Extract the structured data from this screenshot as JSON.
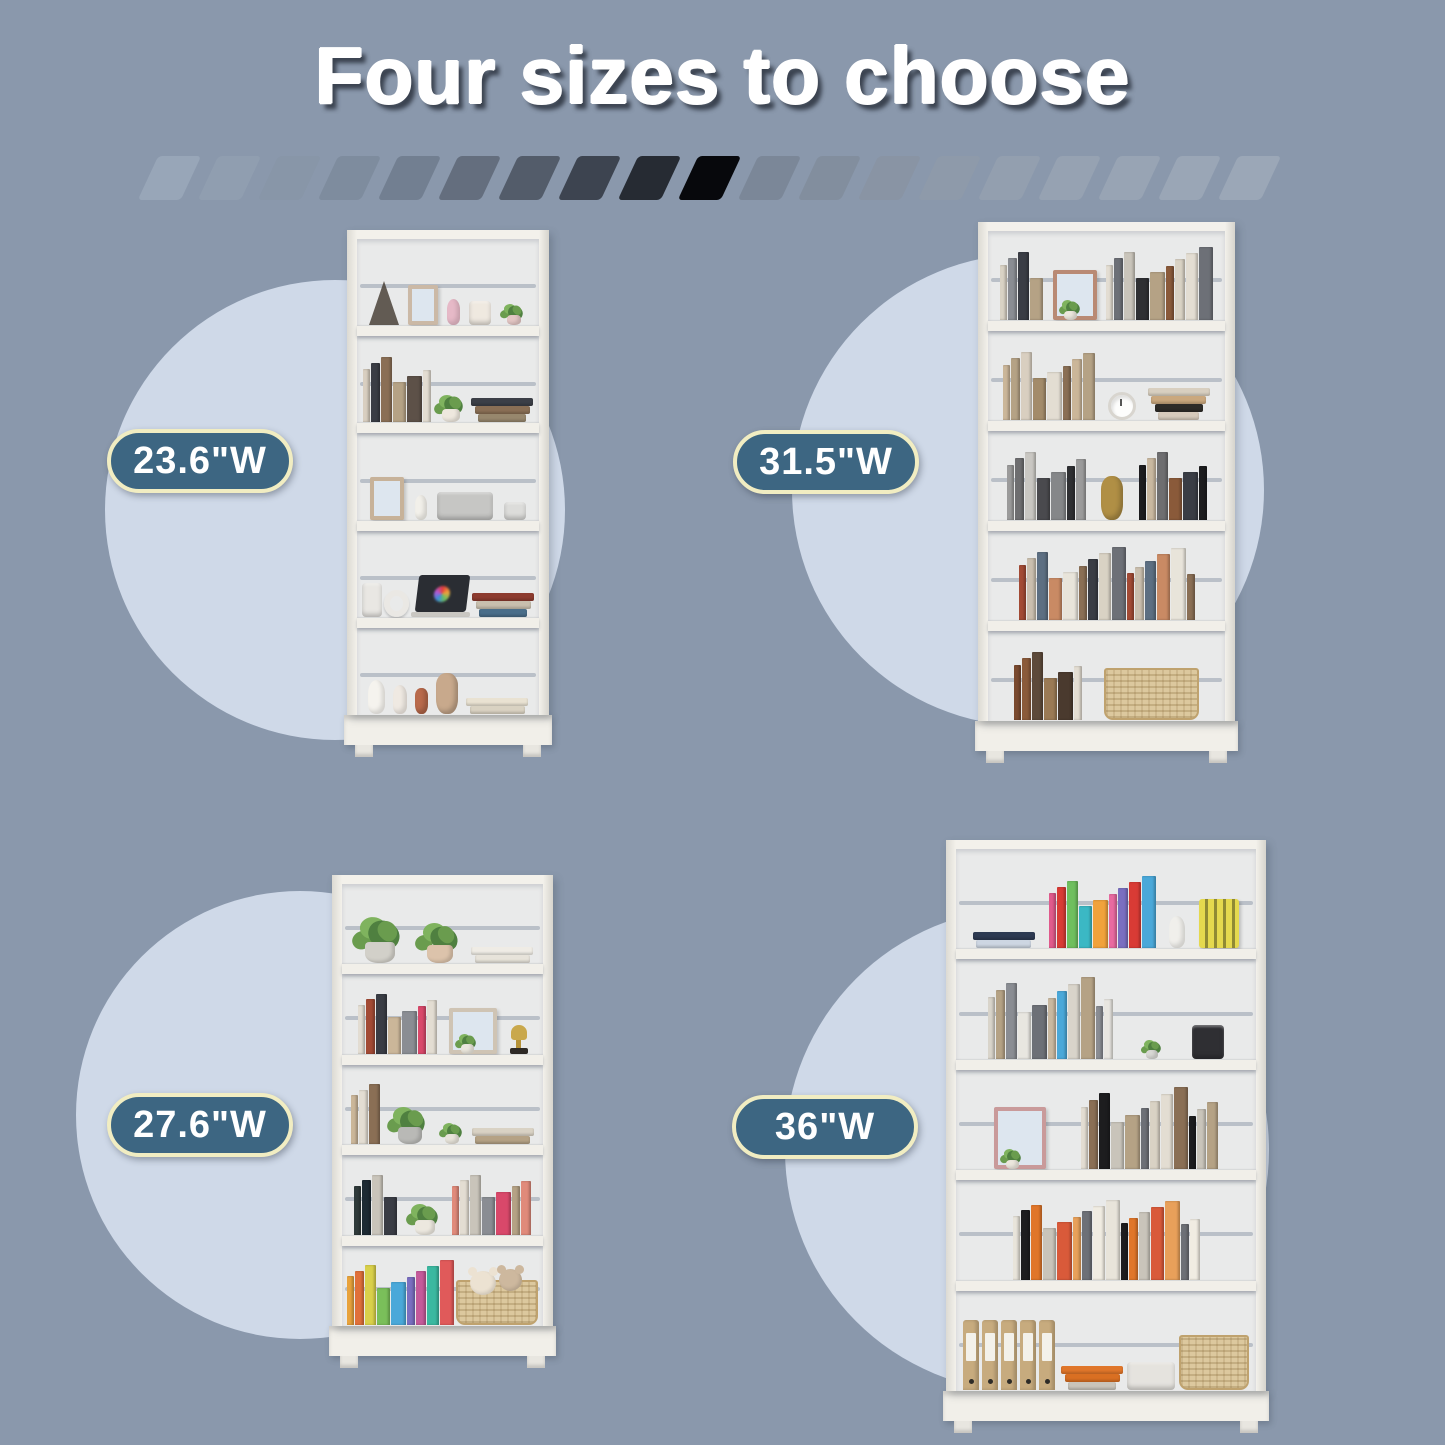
{
  "title": "Four sizes to choose",
  "colors": {
    "background": "#8a98ac",
    "circle": "#cfd9e8",
    "pill_fill": "#3d6682",
    "pill_border": "#f1edc2",
    "pill_text": "#ffffff",
    "title_text": "#ffffff",
    "title_shadow": "#3b4250",
    "case_white": "#f2f0ea"
  },
  "divider": {
    "slash_colors": [
      "#98a6b8",
      "#909eb0",
      "#8896a8",
      "#7e8c9e",
      "#727f91",
      "#646e7e",
      "#535c6a",
      "#3d4450",
      "#262b33",
      "#07080c",
      "#7b8798",
      "#828e9e",
      "#8994a4",
      "#8e9aaa",
      "#939faf",
      "#96a2b2",
      "#98a4b4",
      "#9aa6b6",
      "#9ba7b7"
    ]
  },
  "products": [
    {
      "id": "bookcase-23-6",
      "label": "23.6\"W",
      "layout": {
        "kase": {
          "x": 347,
          "y": 230,
          "w": 202,
          "h": 527
        },
        "circle": {
          "cx": 335,
          "cy": 510,
          "r": 230
        },
        "pill": {
          "cx": 200,
          "cy": 461
        }
      },
      "shelves": [
        [
          {
            "k": "tw"
          },
          {
            "k": "fr",
            "c": "#cbb9a6",
            "w": 30,
            "h": 0.5
          },
          {
            "k": "fg",
            "c": "#e6b9c7",
            "h": 0.32
          },
          {
            "k": "dv",
            "c": "#efe9e0",
            "w": 22,
            "h": 0.3
          },
          {
            "k": "pl",
            "pot": "#e3c6c4",
            "s": 14
          }
        ],
        [
          {
            "k": "bk",
            "n": 6,
            "c": [
              "#d9cfc0",
              "#3a3d45",
              "#8a6f55",
              "#b5a285",
              "#5d5148",
              "#e3ddd2"
            ]
          },
          {
            "k": "pl",
            "pot": "#eee8de",
            "s": 18
          },
          {
            "k": "fl",
            "c": [
              "#3c3f47",
              "#8a6f55",
              "#97876d"
            ]
          }
        ],
        [
          {
            "k": "fr",
            "c": "#c7b299",
            "w": 34,
            "h": 0.52
          },
          {
            "k": "fg",
            "c": "#f2f0ea",
            "h": 0.3
          },
          {
            "k": "dv",
            "c": "#c6c6c4",
            "w": 56,
            "h": 0.34
          },
          {
            "k": "dv",
            "c": "#dcdcda",
            "w": 22,
            "h": 0.22
          }
        ],
        [
          {
            "k": "dv",
            "c": "#e9e7e3",
            "w": 22,
            "h": 0.42
          },
          {
            "k": "hp"
          },
          {
            "k": "lp"
          },
          {
            "k": "fl",
            "c": [
              "#8c3b2f",
              "#c8bfae",
              "#4a6e8a"
            ]
          }
        ],
        [
          {
            "k": "fg",
            "c": "#f5f3ee",
            "h": 0.42
          },
          {
            "k": "fg",
            "c": "#efe9e2",
            "h": 0.36
          },
          {
            "k": "vs",
            "c": "#b96a4b",
            "w": 13,
            "h": 0.32
          },
          {
            "k": "vs",
            "c": "#c8a98c",
            "w": 22,
            "h": 0.5
          },
          {
            "k": "fl",
            "c": [
              "#e9e2d2",
              "#d9d2c2"
            ]
          }
        ]
      ]
    },
    {
      "id": "bookcase-31-5",
      "label": "31.5\"W",
      "layout": {
        "kase": {
          "x": 978,
          "y": 222,
          "w": 257,
          "h": 541
        },
        "circle": {
          "cx": 1028,
          "cy": 490,
          "r": 236
        },
        "pill": {
          "cx": 826,
          "cy": 462
        }
      },
      "shelves": [
        [
          {
            "k": "bk",
            "n": 4,
            "c": [
              "#d9d2c4",
              "#8a8d93",
              "#3a3d45",
              "#b5a285"
            ]
          },
          {
            "k": "fp",
            "c": "#b98a74",
            "w": 44,
            "h": 0.6
          },
          {
            "k": "bk",
            "n": 9,
            "c": [
              "#e3ddd2",
              "#6d7077",
              "#c9c4ba",
              "#2f3033",
              "#b5a285",
              "#8a5a3a",
              "#d9d2c4"
            ]
          }
        ],
        [
          {
            "k": "bk",
            "n": 8,
            "c": [
              "#cbb699",
              "#b5a285",
              "#d9cfc0",
              "#a38b6a",
              "#e3ddd2",
              "#8a6f55"
            ]
          },
          {
            "k": "ck"
          },
          {
            "k": "fl",
            "c": [
              "#d8cfc0",
              "#caa87e",
              "#2e2c28",
              "#d6cabb"
            ]
          }
        ],
        [
          {
            "k": "bk",
            "n": 7,
            "c": [
              "#9b9b9b",
              "#6e6e70",
              "#c9c7c2",
              "#4a4a4e",
              "#858789",
              "#2f3033"
            ]
          },
          {
            "k": "vs",
            "c": "#b08f45",
            "w": 22,
            "h": 0.52
          },
          {
            "k": "bk",
            "n": 6,
            "c": [
              "#1d1d1f",
              "#c9b8a0",
              "#6e6e70",
              "#8a5a3a",
              "#3a3d45"
            ]
          }
        ],
        [
          {
            "k": "bk",
            "n": 15,
            "c": [
              "#a34b35",
              "#cabfae",
              "#5d6f82",
              "#c98a64",
              "#e8e4da",
              "#8a6f55",
              "#3a3d45",
              "#d9d2c4",
              "#6d7077"
            ]
          }
        ],
        [
          {
            "k": "bk",
            "n": 6,
            "c": [
              "#7a4a2f",
              "#8a5a3a",
              "#5d4a3a",
              "#9a7a55",
              "#4a3a2e",
              "#e3ddd2"
            ]
          },
          {
            "k": "bs",
            "w": 95,
            "h": 0.62
          }
        ]
      ]
    },
    {
      "id": "bookcase-27-6",
      "label": "27.6\"W",
      "layout": {
        "kase": {
          "x": 332,
          "y": 875,
          "w": 221,
          "h": 493
        },
        "circle": {
          "cx": 300,
          "cy": 1115,
          "r": 224
        },
        "pill": {
          "cx": 200,
          "cy": 1125
        }
      },
      "shelves": [
        [
          {
            "k": "pl",
            "pot": "#d2d0c9",
            "s": 30
          },
          {
            "k": "pl",
            "pot": "#dcc3ab",
            "s": 26
          },
          {
            "k": "fl",
            "c": [
              "#efece5",
              "#e7e3da"
            ]
          }
        ],
        [
          {
            "k": "bk",
            "n": 7,
            "c": [
              "#e3ddd2",
              "#a34b35",
              "#3a3d45",
              "#cbb699",
              "#8a8d93",
              "#d9486a"
            ]
          },
          {
            "k": "fp",
            "c": "#cfc4b4",
            "w": 48,
            "h": 0.62
          },
          {
            "k": "tr"
          }
        ],
        [
          {
            "k": "bk",
            "n": 3,
            "c": [
              "#cbb699",
              "#e3ddd2",
              "#8a6f55"
            ]
          },
          {
            "k": "pl",
            "pot": "#b9b9b6",
            "s": 24
          },
          {
            "k": "pl",
            "pot": "#e8e4da",
            "s": 14
          },
          {
            "k": "fl",
            "c": [
              "#d9d2c4",
              "#b5a285"
            ]
          }
        ],
        [
          {
            "k": "bk",
            "n": 4,
            "c": [
              "#2f3a3a",
              "#1d2a33",
              "#c9c4ba",
              "#3a3d45"
            ]
          },
          {
            "k": "pl",
            "pot": "#ece8df",
            "s": 20
          },
          {
            "k": "bk",
            "n": 7,
            "c": [
              "#e08a7a",
              "#e3ddd2",
              "#c9c4ba",
              "#8a8d93",
              "#d9486a",
              "#b5a285"
            ]
          }
        ],
        [
          {
            "k": "bk",
            "n": 9,
            "c": [
              "#e8a33c",
              "#e0703a",
              "#d9d04a",
              "#7abf5a",
              "#4aa8d9",
              "#7a6fc0",
              "#c45a9a",
              "#3bb8a0",
              "#e05a5a"
            ]
          },
          {
            "k": "bs",
            "w": 84,
            "h": 0.6,
            "teddy": true
          }
        ]
      ]
    },
    {
      "id": "bookcase-36",
      "label": "36\"W",
      "layout": {
        "kase": {
          "x": 946,
          "y": 840,
          "w": 320,
          "h": 593
        },
        "circle": {
          "cx": 1027,
          "cy": 1150,
          "r": 242
        },
        "pill": {
          "cx": 825,
          "cy": 1127
        }
      },
      "shelves": [
        [
          {
            "k": "fl",
            "c": [
              "#2d3a52",
              "#cdd6e2"
            ]
          },
          {
            "k": "bk",
            "n": 9,
            "c": [
              "#e05a8c",
              "#d93b35",
              "#6fbf5e",
              "#3bb8c4",
              "#f0a23c",
              "#e86aa0",
              "#7a6fc0",
              "#d93b35",
              "#4aa8d9"
            ],
            "mn": 0.45,
            "mx": 0.78
          },
          {
            "k": "fg",
            "c": "#f0efeb",
            "h": 0.34
          },
          {
            "k": "yb"
          }
        ],
        [
          {
            "k": "bk",
            "n": 11,
            "c": [
              "#d9d4ca",
              "#b5a285",
              "#8a8d93",
              "#e8e6e0",
              "#6d7077",
              "#c9b8a0",
              "#4aa8d9"
            ]
          },
          {
            "k": "pl",
            "pot": "#d8d8d4",
            "s": 12
          },
          {
            "k": "dv",
            "c": "#2f2f33",
            "w": 32,
            "h": 0.36
          }
        ],
        [
          {
            "k": "fp",
            "c": "#c99a9a",
            "w": 52,
            "h": 0.66
          },
          {
            "k": "bk",
            "n": 12,
            "c": [
              "#e3ddd2",
              "#8a6f55",
              "#1d1d1f",
              "#c9c4ba",
              "#b5a285",
              "#6d7077",
              "#d9d2c4"
            ]
          }
        ],
        [
          {
            "k": "bk",
            "n": 16,
            "c": [
              "#e8e4da",
              "#1d1d1f",
              "#e0762a",
              "#c9c4ba",
              "#d95a3a",
              "#e8a05a",
              "#6d7077",
              "#f0ece2"
            ],
            "mn": 0.55,
            "mx": 0.85
          }
        ],
        [
          {
            "k": "bn",
            "n": 5,
            "c": "#c7ab7e"
          },
          {
            "k": "fl",
            "c": [
              "#e0762a",
              "#d96f22",
              "#c9c4ba"
            ]
          },
          {
            "k": "dv",
            "c": "#e5e3de",
            "w": 48,
            "h": 0.3
          },
          {
            "k": "bs",
            "w": 70,
            "h": 0.58
          }
        ]
      ]
    }
  ]
}
